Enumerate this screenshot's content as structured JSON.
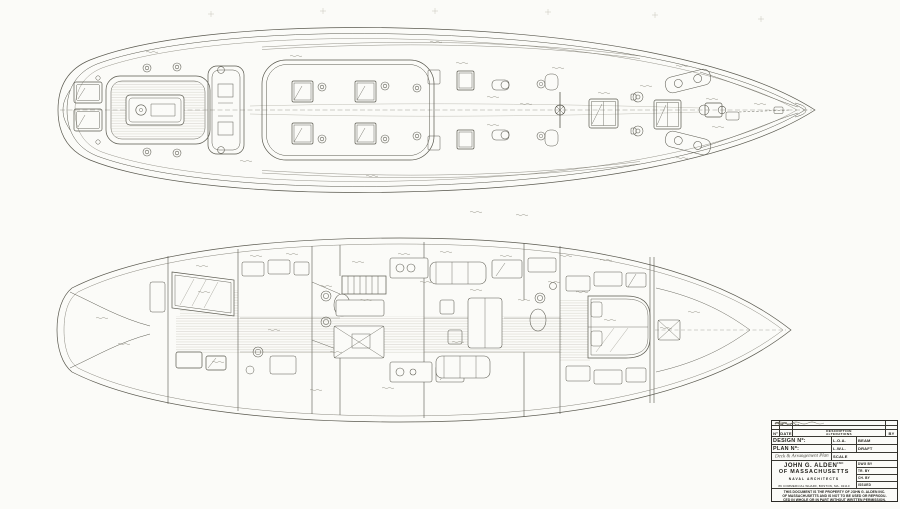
{
  "page": {
    "background": "#fbfbf8",
    "ink": "#5a594f"
  },
  "drawings": {
    "deck_plan": {
      "name": "deck plan"
    },
    "arrangement_plan": {
      "name": "interior arrangement plan"
    }
  },
  "title_block": {
    "revision_table": {
      "no_label": "Nº",
      "date_label": "DATE",
      "description_label": "DESCRIPTION",
      "alterations_label": "ALTERATIONS",
      "by_label": "BY"
    },
    "fields": {
      "design_no_label": "DESIGN Nº:",
      "plan_no_label": "PLAN Nº:",
      "loa_label": "L.O.A.",
      "lwl_label": "L.W.L.",
      "beam_label": "BEAM",
      "draft_label": "DRAFT",
      "scale_label": "SCALE",
      "dwg_by_label": "DWG BY",
      "tr_by_label": "TR. BY",
      "ch_by_label": "CH. BY",
      "issued_label": "ISSUED"
    },
    "handwritten": {
      "plan_title": "Deck & Arrangement Plan"
    },
    "firm": {
      "name_line1": "JOHN G. ALDEN",
      "name_suffix": "INC",
      "name_line2": "OF MASSACHUSETTS",
      "subtitle": "NAVAL ARCHITECTS",
      "address": "89 COMMERCIAL WHARF, BOSTON, MA. 02110"
    },
    "disclaimer_line1": "THIS DOCUMENT IS THE PROPERTY OF JOHN G. ALDEN INC.",
    "disclaimer_line2": "OF MASSACHUSETTS AND IS NOT TO BE USED OR REPRODU-",
    "disclaimer_line3": "CED IN WHOLE OR IN PART WITHOUT WRITTEN PERMISSION."
  }
}
